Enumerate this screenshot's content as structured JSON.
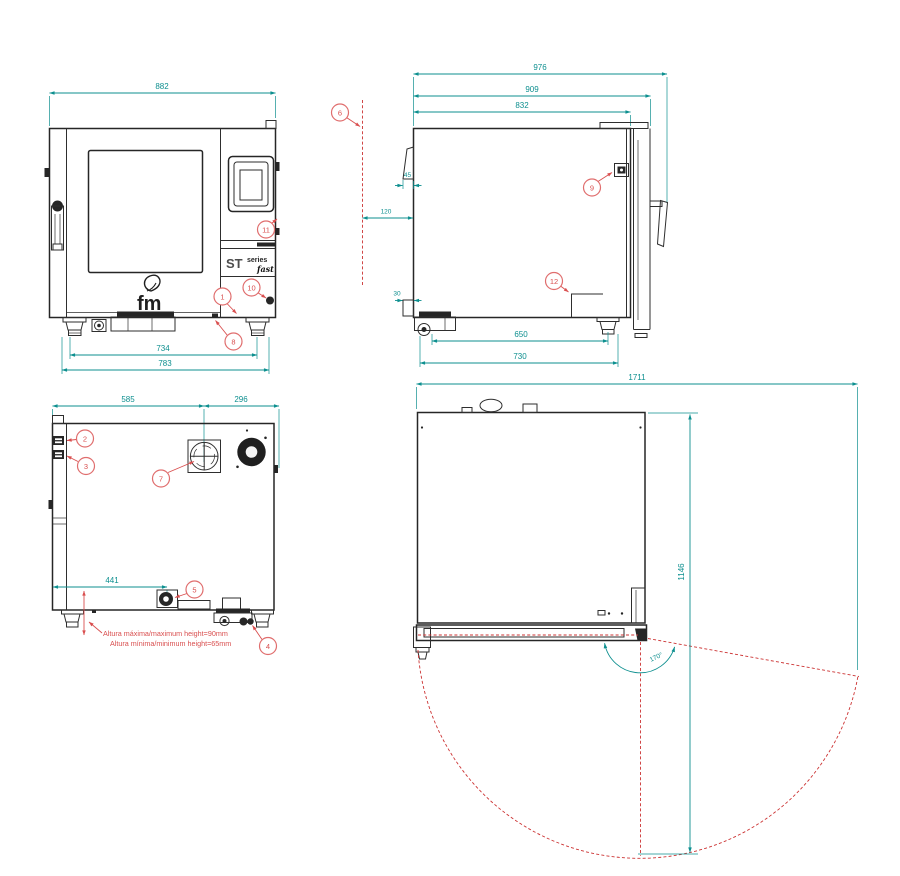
{
  "drawing": {
    "product": "fm ST series oven dimensional drawing",
    "units": "mm"
  },
  "colors": {
    "dimension": "#0d8f8f",
    "annotation": "#dd5f5f",
    "swing_line": "#cc3333",
    "body_line": "#2e2e2e"
  },
  "branding": {
    "logo": "fm",
    "series": "ST",
    "series_word": "series",
    "series_script": "fast"
  },
  "views": {
    "front": {
      "dims": {
        "overall_width": "882",
        "feet_centers": "734",
        "feet_overall": "783"
      },
      "callouts": [
        "1",
        "8",
        "10",
        "11"
      ]
    },
    "side": {
      "dims": {
        "overall_depth": "976",
        "depth_to_door_face": "909",
        "body_depth": "832",
        "chimney_width": "45",
        "rear_clearance": "120",
        "drain_step": "30",
        "feet_centers": "650",
        "feet_overall": "730"
      },
      "callouts": [
        "6",
        "9",
        "12"
      ]
    },
    "rear": {
      "dims": {
        "vent_center_from_left": "585",
        "vent_center_to_right": "296",
        "drain_from_left": "441"
      },
      "callouts": [
        "2",
        "3",
        "7",
        "5",
        "4"
      ],
      "notes": [
        "Altura máxima/maximum height=90mm",
        "Altura mínima/minimum height=65mm"
      ]
    },
    "top": {
      "dims": {
        "overall_width_door_open": "1711",
        "door_swing_depth": "1146",
        "door_opening_angle": "170°"
      }
    }
  }
}
